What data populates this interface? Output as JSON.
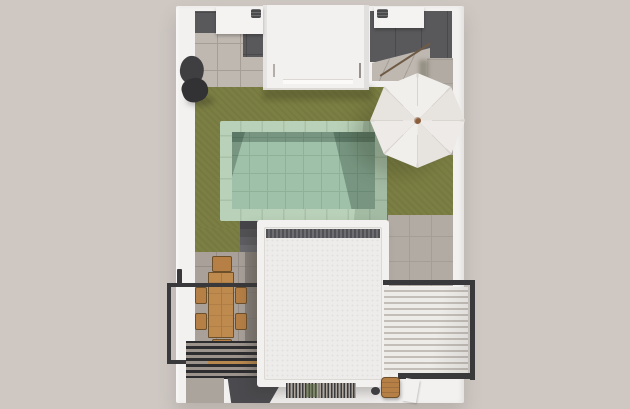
{
  "meta": {
    "type": "3d-architectural-render",
    "view": "top-down-aerial",
    "subject": "villa rooftop terrace plan with swimming pool, lawn, parasol, dining set and pergolas",
    "text_content": "none (image contains no visible text)"
  },
  "objects": [
    "perimeter-white-walls",
    "utility-alcove-left",
    "utility-alcove-right",
    "ac-unit-left",
    "ac-unit-right",
    "central-stair-volume",
    "artificial-lawn",
    "swimming-pool",
    "pool-coping",
    "pool-steps",
    "cantilever-parasol",
    "dark-lounger",
    "stone-paving",
    "dining-table",
    "dining-chairs",
    "balcony-railing",
    "dark-louver-pergola",
    "white-flat-roof",
    "white-louvered-pergola",
    "floor-grating",
    "wooden-stool",
    "kettle-grill"
  ],
  "colors": {
    "bg": "#cec7c2",
    "wall": "#f3f1ef",
    "wallEdge": "#dcd8d4",
    "lawn": "#7c7f43",
    "lawnShadow": "rgba(50,52,24,0.30)",
    "darkTile": "#59595b",
    "darkTileLine": "#4a4a4c",
    "stone": "#bfb8b1",
    "stoneDark": "#b2aba4",
    "stoneLine": "#a59e97",
    "coping": "#bad1b9",
    "copingLine": "#a9c1a8",
    "water": "#9fc1a9",
    "waterLine": "#8eb198",
    "waterShadow": "rgba(25,50,38,0.30)",
    "waterShadowSoft": "rgba(25,50,38,0.14)",
    "terrace": "#a8a099",
    "terraceLine": "#958d86",
    "terraceShade": "#7b746d",
    "railing": "#39393b",
    "wood": "#bf8a4e",
    "woodChair": "#b57f45",
    "woodDark": "#6d4f2a",
    "woodSeam": "#a87a3e",
    "roofField": "#eeecea",
    "roofDot": "#e3e0dd",
    "roofStrip1": "#515156",
    "roofStrip2": "#6c6c71",
    "slatWhite": "#eeece9",
    "slatGapWhite": "#c4beb8",
    "darkSlat": "#2d2d2f",
    "darkSlatGap": "#9b938c",
    "beam": "#b8894f",
    "wedgeDark": "#4b4b4f",
    "grateDark": "#39393b",
    "grateLight": "#aca69f",
    "grateGreen": "#5c6b42",
    "umb": "#f1efec",
    "umb2": "#edeae7",
    "umbShade": "#e7e4e0",
    "umbRib": "#d9d5d1",
    "umbKnob": "#8a5d3b",
    "acBox": "#f4f3f1",
    "acVent": "#4a4a4c",
    "objDark": "#3f3f42",
    "armLine": "#6f5b45"
  }
}
